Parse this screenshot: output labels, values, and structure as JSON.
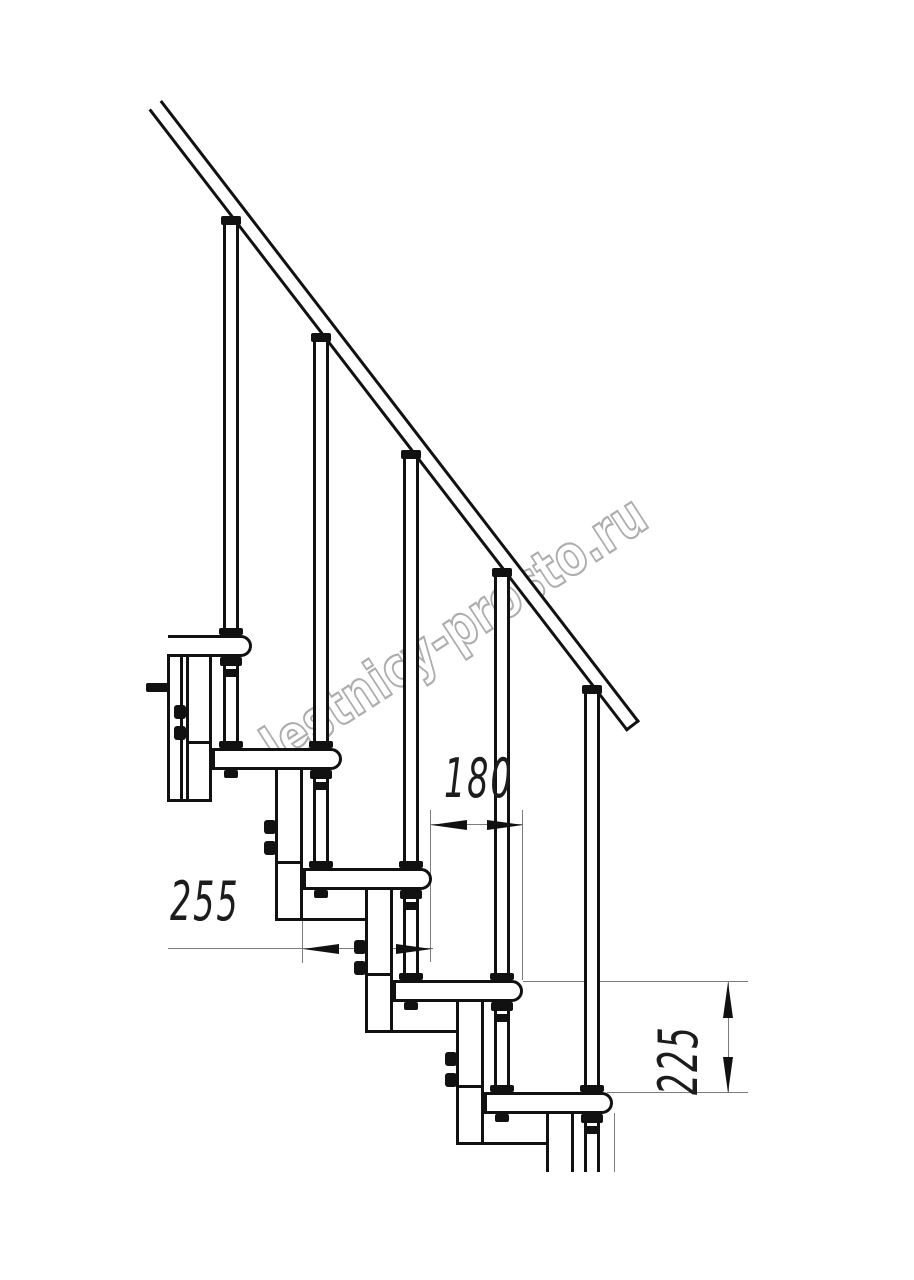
{
  "page": {
    "width": 914,
    "height": 1280,
    "background": "#ffffff"
  },
  "watermark": {
    "text": "lestnicy-prosto.ru",
    "color": "#adadad"
  },
  "dims": {
    "d180": {
      "label": "180"
    },
    "d255": {
      "label": "255"
    },
    "d225": {
      "label": "225"
    }
  },
  "figure": {
    "line_color": "#111111",
    "dim_line_color": "#7c7c7c",
    "rail": {
      "x": 162,
      "y": 100,
      "len": 784,
      "thick": 17,
      "angle": 52.43
    },
    "steps": [
      {
        "tread": {
          "x": 168,
          "y": 635,
          "w": 84,
          "open_left": true
        },
        "baluster": {
          "x": 223,
          "top": 225,
          "h": 410,
          "flange_y": 216
        },
        "post": {
          "flange_y": 657,
          "clamp_y": 669,
          "body_y": 666,
          "body_h": 75,
          "base_y": 741,
          "through_y": 770
        },
        "column": {
          "x": 186,
          "y": 654,
          "w": 26,
          "h": 147,
          "mid_y": 741,
          "bolt_x": 174,
          "bolt_y": [
            705,
            726
          ]
        }
      },
      {
        "tread": {
          "x": 212,
          "y": 748,
          "w": 130
        },
        "baluster": {
          "x": 313,
          "top": 342,
          "h": 406,
          "flange_y": 333
        },
        "post": {
          "flange_y": 770,
          "clamp_y": 782,
          "body_y": 779,
          "body_h": 82,
          "base_y": 861,
          "through_y": 890
        },
        "column": {
          "x": 275,
          "y": 767,
          "w": 28,
          "h": 154,
          "mid_y": 861,
          "bolt_x": 264,
          "bolt_y": [
            820,
            841
          ]
        }
      },
      {
        "tread": {
          "x": 303,
          "y": 868,
          "w": 129
        },
        "baluster": {
          "x": 403,
          "top": 459,
          "h": 409,
          "flange_y": 450
        },
        "post": {
          "flange_y": 890,
          "clamp_y": 902,
          "body_y": 899,
          "body_h": 74,
          "base_y": 973,
          "through_y": 1002
        },
        "column": {
          "x": 365,
          "y": 887,
          "w": 28,
          "h": 146,
          "mid_y": 973,
          "bolt_x": 354,
          "bolt_y": [
            940,
            961
          ]
        }
      },
      {
        "tread": {
          "x": 393,
          "y": 980,
          "w": 130
        },
        "baluster": {
          "x": 494,
          "top": 577,
          "h": 403,
          "flange_y": 568
        },
        "post": {
          "flange_y": 1002,
          "clamp_y": 1014,
          "body_y": 1011,
          "body_h": 74,
          "base_y": 1085,
          "through_y": 1114
        },
        "column": {
          "x": 456,
          "y": 999,
          "w": 28,
          "h": 146,
          "mid_y": 1085,
          "bolt_x": 445,
          "bolt_y": [
            1052,
            1073
          ]
        }
      },
      {
        "tread": {
          "x": 484,
          "y": 1092,
          "w": 129
        },
        "baluster": {
          "x": 584,
          "top": 694,
          "h": 398,
          "flange_y": 685
        },
        "post": {
          "flange_y": 1114,
          "clamp_y": 1126,
          "body_y": 1123,
          "body_h": 49
        },
        "column": {
          "x": 546,
          "y": 1111,
          "w": 28,
          "h": 61
        }
      }
    ],
    "connectors": [
      {
        "x": 167,
        "y": 799,
        "w": 45
      },
      {
        "x": 275,
        "y": 918,
        "w": 90
      },
      {
        "x": 365,
        "y": 1030,
        "w": 91
      },
      {
        "x": 456,
        "y": 1142,
        "w": 90
      }
    ],
    "strip": {
      "x": 167,
      "y": 654,
      "w": 16,
      "h": 148
    },
    "rod": {
      "x": 146,
      "y": 683,
      "w": 22,
      "h": 9
    }
  }
}
